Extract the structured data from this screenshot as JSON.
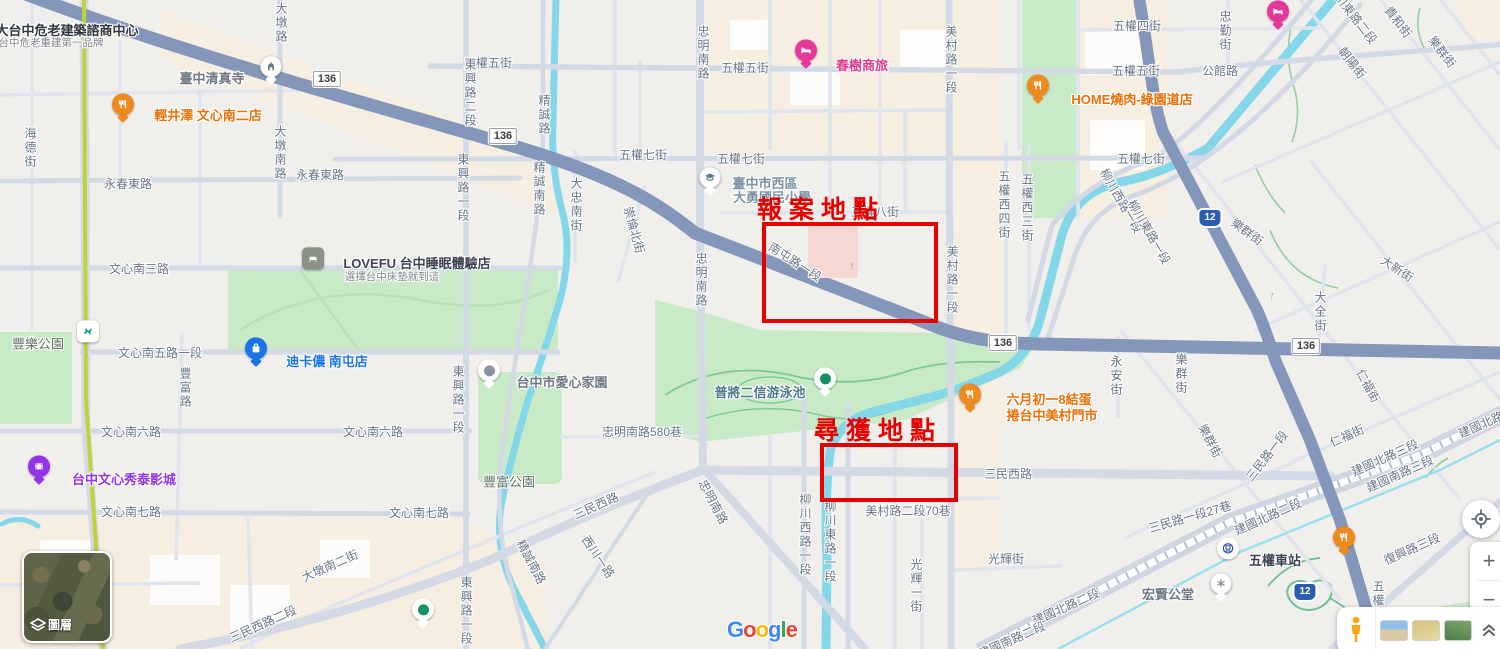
{
  "annotations": {
    "color": "#e60000",
    "report": {
      "label": "報案地點",
      "rect": {
        "x": 762,
        "y": 222,
        "w": 176,
        "h": 101
      },
      "label_x": 757,
      "label_y": 197
    },
    "found": {
      "label": "尋獲地點",
      "rect": {
        "x": 820,
        "y": 443,
        "w": 138,
        "h": 59
      },
      "label_x": 814,
      "label_y": 418
    }
  },
  "attribution": {
    "google": "Google"
  },
  "controls": {
    "layers_label": "圖層",
    "zoom_in": "+",
    "zoom_out": "−"
  },
  "shields": [
    {
      "type": "white",
      "text": "136",
      "x": 327,
      "y": 79
    },
    {
      "type": "white",
      "text": "136",
      "x": 503,
      "y": 136
    },
    {
      "type": "white",
      "text": "136",
      "x": 1003,
      "y": 343
    },
    {
      "type": "white",
      "text": "136",
      "x": 1306,
      "y": 346
    },
    {
      "type": "blue",
      "text": "12",
      "x": 1210,
      "y": 218
    },
    {
      "type": "blue",
      "text": "12",
      "x": 1305,
      "y": 592
    }
  ],
  "arrows": [
    {
      "x": 852,
      "y": 266,
      "rot": 0
    },
    {
      "x": 1272,
      "y": 296,
      "rot": 10
    },
    {
      "x": 950,
      "y": 263,
      "rot": 0
    }
  ],
  "map": {
    "street_labels": [
      {
        "t": "五權五街",
        "x": 488,
        "y": 63
      },
      {
        "t": "五權五街",
        "x": 745,
        "y": 68
      },
      {
        "t": "五權五街",
        "x": 1136,
        "y": 71
      },
      {
        "t": "五權四街",
        "x": 1137,
        "y": 26
      },
      {
        "t": "五權七街",
        "x": 643,
        "y": 155
      },
      {
        "t": "五權七街",
        "x": 741,
        "y": 159
      },
      {
        "t": "五權七街",
        "x": 1141,
        "y": 159
      },
      {
        "t": "公館路",
        "x": 1220,
        "y": 71
      },
      {
        "t": "五權八街",
        "x": 875,
        "y": 212
      },
      {
        "t": "永春東路",
        "x": 128,
        "y": 184
      },
      {
        "t": "永春東路",
        "x": 320,
        "y": 175
      },
      {
        "t": "文心南三路",
        "x": 139,
        "y": 269
      },
      {
        "t": "文心南五路一段",
        "x": 160,
        "y": 353
      },
      {
        "t": "文心南六路",
        "x": 131,
        "y": 432
      },
      {
        "t": "文心南六路",
        "x": 373,
        "y": 432
      },
      {
        "t": "文心南七路",
        "x": 131,
        "y": 512
      },
      {
        "t": "文心南七路",
        "x": 419,
        "y": 513
      },
      {
        "t": "忠明南路580巷",
        "x": 642,
        "y": 432
      },
      {
        "t": "美村路二段70巷",
        "x": 908,
        "y": 511
      },
      {
        "t": "光輝街",
        "x": 1006,
        "y": 559
      },
      {
        "t": "三民西路",
        "x": 1008,
        "y": 474
      },
      {
        "t": "豐樂公園",
        "x": 38,
        "y": 344,
        "cls": "park big"
      },
      {
        "t": "豐富公園",
        "x": 509,
        "y": 482,
        "cls": "park big"
      },
      {
        "t": "海德街",
        "x": 30,
        "y": 148,
        "v": true
      },
      {
        "t": "大墩路",
        "x": 281,
        "y": 23,
        "v": true
      },
      {
        "t": "大墩南路",
        "x": 280,
        "y": 153,
        "v": true
      },
      {
        "t": "東興路二段",
        "x": 470,
        "y": 93,
        "v": true
      },
      {
        "t": "東興路一段",
        "x": 463,
        "y": 188,
        "v": true
      },
      {
        "t": "東興路一段",
        "x": 458,
        "y": 400,
        "v": true
      },
      {
        "t": "東興路一段",
        "x": 466,
        "y": 611,
        "v": true
      },
      {
        "t": "精誠路",
        "x": 544,
        "y": 115,
        "v": true
      },
      {
        "t": "精誠南路",
        "x": 539,
        "y": 189,
        "v": true
      },
      {
        "t": "大忠南街",
        "x": 576,
        "y": 205,
        "v": true
      },
      {
        "t": "忠明南路",
        "x": 703,
        "y": 53,
        "v": true
      },
      {
        "t": "忠明南路",
        "x": 701,
        "y": 280,
        "v": true
      },
      {
        "t": "美村路一段",
        "x": 951,
        "y": 60,
        "v": true
      },
      {
        "t": "美村路一段",
        "x": 952,
        "y": 280,
        "v": true
      },
      {
        "t": "五權西四街",
        "x": 1004,
        "y": 205,
        "v": true
      },
      {
        "t": "五權西三街",
        "x": 1027,
        "y": 208,
        "v": true
      },
      {
        "t": "忠勤街",
        "x": 1225,
        "y": 31,
        "v": true
      },
      {
        "t": "豐富路",
        "x": 185,
        "y": 388,
        "v": true
      },
      {
        "t": "柳川西路一段",
        "x": 805,
        "y": 535,
        "v": true
      },
      {
        "t": "柳川東路一段",
        "x": 830,
        "y": 542,
        "v": true
      },
      {
        "t": "光輝一街",
        "x": 916,
        "y": 586,
        "v": true
      },
      {
        "t": "永安街",
        "x": 1116,
        "y": 376,
        "v": true
      },
      {
        "t": "樂群街",
        "x": 1181,
        "y": 374,
        "v": true
      },
      {
        "t": "大全街",
        "x": 1320,
        "y": 312,
        "v": true
      },
      {
        "t": "五權南路",
        "x": 1378,
        "y": 608,
        "v": true
      },
      {
        "t": "南屯路一段",
        "x": 795,
        "y": 262,
        "rot": 33
      },
      {
        "t": "崇倫北街",
        "x": 634,
        "y": 230,
        "rot": 75
      },
      {
        "t": "三民西路",
        "x": 596,
        "y": 506,
        "rot": -24
      },
      {
        "t": "三民西路二段",
        "x": 263,
        "y": 624,
        "rot": -24
      },
      {
        "t": "大墩南二街",
        "x": 330,
        "y": 566,
        "rot": -24
      },
      {
        "t": "西川一路",
        "x": 598,
        "y": 557,
        "rot": 56
      },
      {
        "t": "精誠南路",
        "x": 531,
        "y": 562,
        "rot": 62
      },
      {
        "t": "忠明南路",
        "x": 713,
        "y": 502,
        "rot": 62
      },
      {
        "t": "柳川西路一段",
        "x": 1121,
        "y": 201,
        "rot": 60
      },
      {
        "t": "柳川東路一段",
        "x": 1149,
        "y": 232,
        "rot": 60
      },
      {
        "t": "柳川東路二段",
        "x": 1352,
        "y": 14,
        "rot": 52
      },
      {
        "t": "貴和街",
        "x": 1398,
        "y": 22,
        "rot": 52
      },
      {
        "t": "樂群街",
        "x": 1442,
        "y": 52,
        "rot": 52
      },
      {
        "t": "朝陽街",
        "x": 1352,
        "y": 63,
        "rot": 52
      },
      {
        "t": "樂群街",
        "x": 1247,
        "y": 232,
        "rot": 36
      },
      {
        "t": "大新街",
        "x": 1397,
        "y": 269,
        "rot": 33
      },
      {
        "t": "樂群街",
        "x": 1210,
        "y": 441,
        "rot": 62
      },
      {
        "t": "仁福街",
        "x": 1368,
        "y": 386,
        "rot": 62
      },
      {
        "t": "仁福街",
        "x": 1347,
        "y": 436,
        "rot": -24
      },
      {
        "t": "三民路一段",
        "x": 1267,
        "y": 456,
        "rot": -52
      },
      {
        "t": "三民路一段27巷",
        "x": 1190,
        "y": 517,
        "rot": -16
      },
      {
        "t": "建國北路二段",
        "x": 1268,
        "y": 517,
        "rot": -24
      },
      {
        "t": "建國北路二段",
        "x": 1066,
        "y": 607,
        "rot": -24
      },
      {
        "t": "建國南路二段",
        "x": 1012,
        "y": 640,
        "rot": -24
      },
      {
        "t": "建國北路三段",
        "x": 1385,
        "y": 458,
        "rot": -24
      },
      {
        "t": "建國南路三段",
        "x": 1400,
        "y": 474,
        "rot": -24
      },
      {
        "t": "建國北路三段",
        "x": 1492,
        "y": 420,
        "rot": -24
      },
      {
        "t": "復興路三段",
        "x": 1412,
        "y": 549,
        "rot": -24
      }
    ],
    "pois": [
      {
        "icon": "restaurant",
        "cls": "c-orange",
        "px": 123,
        "py": 114,
        "name": "輕井澤 文心南二店",
        "lx": 208,
        "ly": 116
      },
      {
        "icon": "mosque",
        "cls": "c-gray",
        "px": 271,
        "py": 76,
        "name": "臺中清真寺",
        "lx": 212,
        "ly": 79
      },
      {
        "cls": "c-title",
        "name": "大台中危老建築諮商中心",
        "lx": 67,
        "ly": 31,
        "sub": "台中危老重建第一品牌",
        "sx": 51,
        "sy": 44
      },
      {
        "icon": "hotel",
        "cls": "c-pink",
        "px": 806,
        "py": 60,
        "name": "春樹商旅",
        "lx": 862,
        "ly": 66
      },
      {
        "icon": "restaurant",
        "cls": "c-orange",
        "px": 1038,
        "py": 95,
        "name": "HOME燒肉-綠園道店",
        "lx": 1132,
        "ly": 100
      },
      {
        "icon": "school",
        "cls": "c-school",
        "px": 710,
        "py": 187,
        "name": "臺中市西區",
        "lx": 765,
        "ly": 184,
        "sub2": "大勇國民小學",
        "sx": 772,
        "sy": 198
      },
      {
        "icon": "store",
        "cls": "c-dark",
        "px": 313,
        "py": 268,
        "name": "LOVEFU 台中睡眠體驗店",
        "lx": 417,
        "ly": 264,
        "sub": "選擇台中床墊就到這",
        "sx": 392,
        "sy": 278
      },
      {
        "icon": "shopping",
        "cls": "c-blue",
        "px": 256,
        "py": 358,
        "name": "迪卡儂 南屯店",
        "lx": 327,
        "ly": 362
      },
      {
        "icon": "mrt",
        "px": 88,
        "py": 341
      },
      {
        "icon": "dotgray",
        "cls": "c-gray",
        "px": 489,
        "py": 380,
        "name": "台中市愛心家園",
        "lx": 562,
        "ly": 383
      },
      {
        "icon": "dotgreen",
        "cls": "c-teal",
        "px": 825,
        "py": 388,
        "name": "普將二信游泳池",
        "lx": 760,
        "ly": 393
      },
      {
        "icon": "cinema",
        "cls": "c-purple",
        "px": 39,
        "py": 476,
        "name": "台中文心秀泰影城",
        "lx": 124,
        "ly": 480
      },
      {
        "icon": "restaurant",
        "cls": "c-orange",
        "px": 970,
        "py": 404,
        "name": "六月初一8結蛋",
        "lx": 1049,
        "ly": 400,
        "sub2": "捲台中美村門市",
        "sx": 1052,
        "sy": 416
      },
      {
        "icon": "train",
        "cls": "c-dark",
        "px": 1228,
        "py": 558,
        "name": "五權車站",
        "lx": 1275,
        "ly": 561
      },
      {
        "icon": "temple",
        "cls": "c-gray",
        "px": 1221,
        "py": 593,
        "name": "宏賢公堂",
        "lx": 1168,
        "ly": 595
      },
      {
        "icon": "restaurant",
        "px": 1344,
        "py": 547
      },
      {
        "icon": "hotel",
        "px": 1278,
        "py": 21
      },
      {
        "icon": "dotgreen",
        "px": 423,
        "py": 619
      }
    ]
  }
}
